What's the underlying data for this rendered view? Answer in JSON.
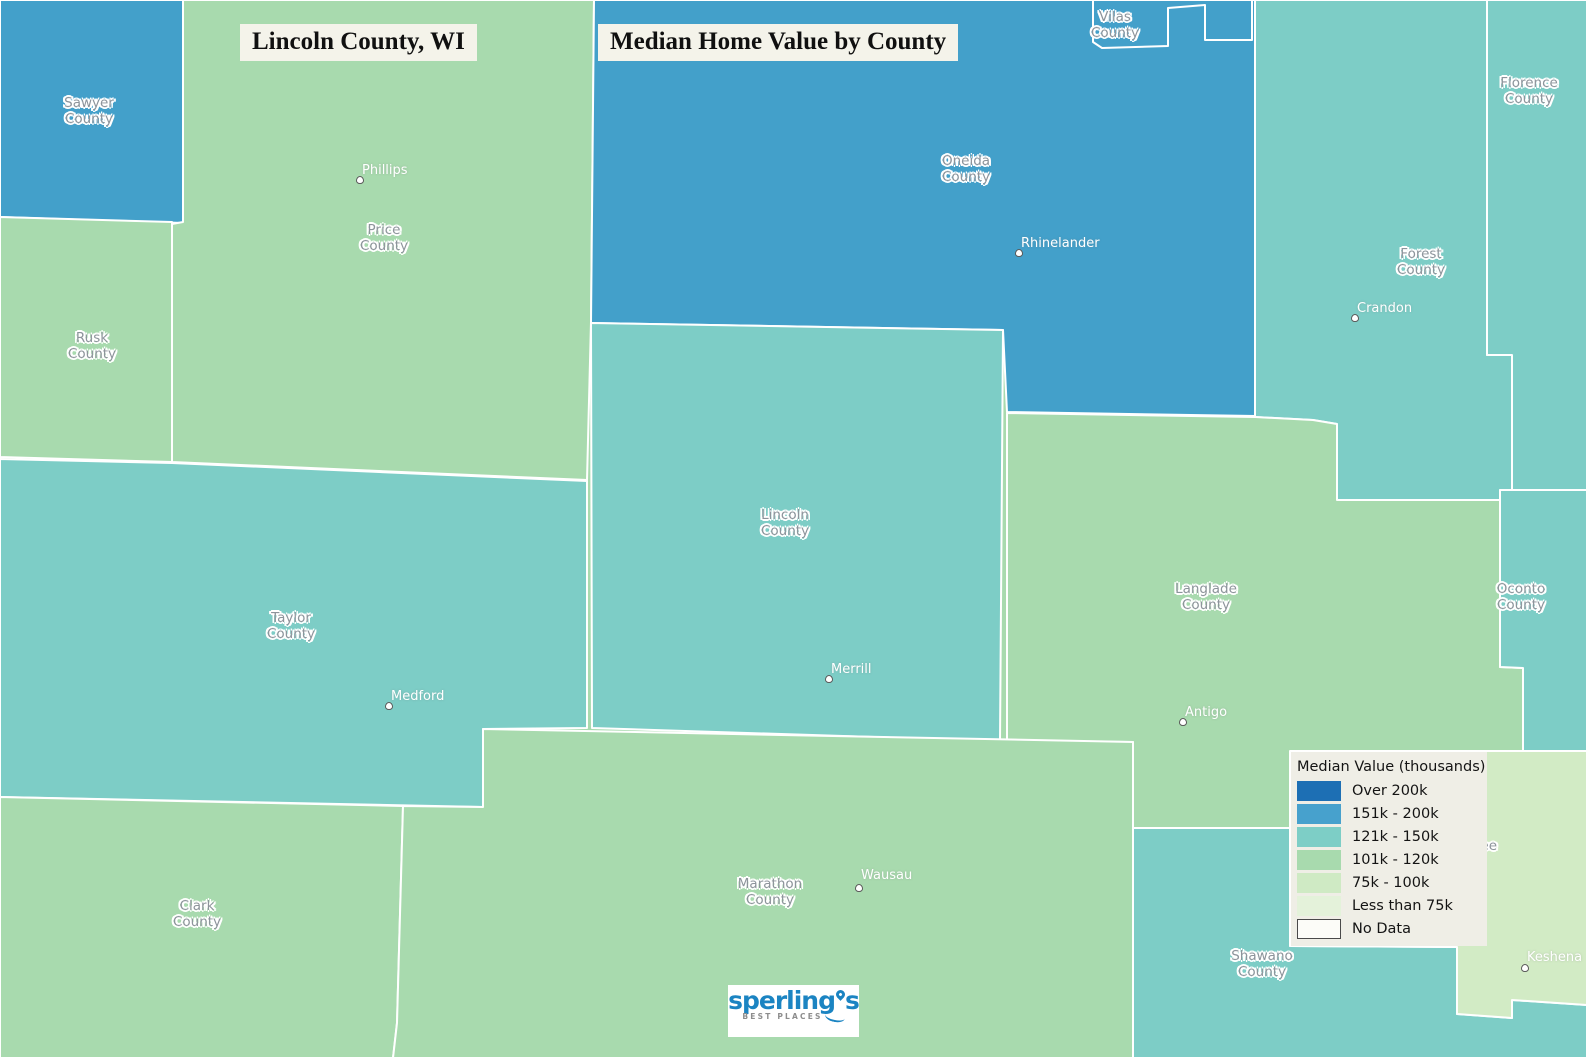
{
  "titles": {
    "county": "Lincoln County, WI",
    "map": "Median Home Value by County"
  },
  "palette": {
    "over_200k": "#1d6fb4",
    "k151_200": "#47a1cd",
    "k121_150": "#7dcec6",
    "k101_120": "#a8daae",
    "k75_100": "#cfeac4",
    "under_75k": "#e4f2da",
    "no_data": "#fcfcf8",
    "boundary": "#ffffff",
    "label_gray": "#8d949b",
    "brand_blue": "#1b84c2"
  },
  "legend": {
    "title": "Median Value (thousands)",
    "items": [
      {
        "label": "Over 200k",
        "color": "#1d6fb4"
      },
      {
        "label": "151k - 200k",
        "color": "#47a1cd"
      },
      {
        "label": "121k - 150k",
        "color": "#7dcec6"
      },
      {
        "label": "101k - 120k",
        "color": "#a8daae"
      },
      {
        "label": "75k - 100k",
        "color": "#cfeac4"
      },
      {
        "label": "Less than 75k",
        "color": "#e4f2da"
      },
      {
        "label": "No Data",
        "color": "#fcfcf8"
      }
    ]
  },
  "counties": [
    {
      "name": "Sawyer",
      "label": "Sawyer\nCounty",
      "range": "151k - 200k",
      "color": "#43a0ca"
    },
    {
      "name": "Price",
      "label": "Price\nCounty",
      "range": "101k - 120k",
      "color": "#a8daae"
    },
    {
      "name": "Rusk",
      "label": "Rusk\nCounty",
      "range": "101k - 120k",
      "color": "#a8daae"
    },
    {
      "name": "Oneida",
      "label": "Oneida\nCounty",
      "range": "151k - 200k",
      "color": "#43a0ca"
    },
    {
      "name": "Vilas",
      "label": "Vilas\nCounty",
      "range": "151k - 200k",
      "color": "#43a0ca"
    },
    {
      "name": "Forest",
      "label": "Forest\nCounty",
      "range": "121k - 150k",
      "color": "#7dcdc6"
    },
    {
      "name": "Florence",
      "label": "Florence\nCounty",
      "range": "121k - 150k",
      "color": "#7dcdc6"
    },
    {
      "name": "Lincoln",
      "label": "Lincoln\nCounty",
      "range": "121k - 150k",
      "color": "#7dcdc6"
    },
    {
      "name": "Taylor",
      "label": "Taylor\nCounty",
      "range": "121k - 150k",
      "color": "#7dcdc6"
    },
    {
      "name": "Langlade",
      "label": "Langlade\nCounty",
      "range": "101k - 120k",
      "color": "#a8daae"
    },
    {
      "name": "Oconto",
      "label": "Oconto\nCounty",
      "range": "121k - 150k",
      "color": "#7dcdc6"
    },
    {
      "name": "Clark",
      "label": "Clark\nCounty",
      "range": "101k - 120k",
      "color": "#a8daae"
    },
    {
      "name": "Marathon",
      "label": "Marathon\nCounty",
      "range": "101k - 120k",
      "color": "#a8daae"
    },
    {
      "name": "Shawano",
      "label": "Shawano\nCounty",
      "range": "121k - 150k",
      "color": "#7dcdc6"
    },
    {
      "name": "Menominee",
      "label": "Menominee",
      "range": "75k - 100k",
      "color": "#d2ebc5"
    }
  ],
  "cities": [
    {
      "name": "Phillips"
    },
    {
      "name": "Rhinelander"
    },
    {
      "name": "Crandon"
    },
    {
      "name": "Merrill"
    },
    {
      "name": "Medford"
    },
    {
      "name": "Antigo"
    },
    {
      "name": "Wausau"
    },
    {
      "name": "Keshena"
    }
  ],
  "logo": {
    "brand_head": "sperling",
    "brand_tail": "s",
    "tagline": "BEST PLACES"
  }
}
